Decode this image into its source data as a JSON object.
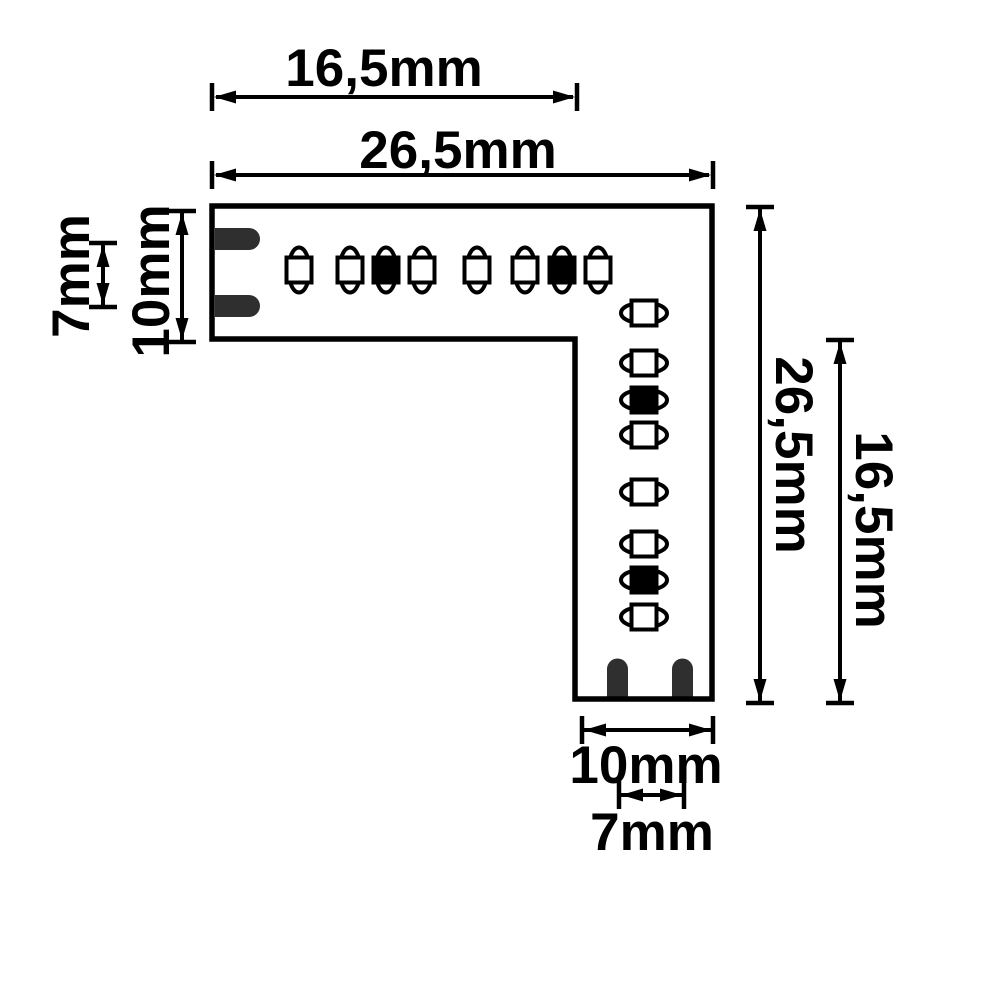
{
  "dimensions": {
    "top_inner": "16,5mm",
    "top_full": "26,5mm",
    "left_pad_pitch": "7mm",
    "left_strip_width": "10mm",
    "right_full": "26,5mm",
    "right_inner": "16,5mm",
    "bottom_strip_width": "10mm",
    "bottom_pad_pitch": "7mm"
  },
  "leds": {
    "horizontal_row_count": 8,
    "vertical_column_count": 8,
    "marked_row_positions": [
      3,
      7
    ],
    "marked_column_positions": [
      3,
      7
    ]
  },
  "pads": {
    "left_count": 2,
    "bottom_count": 2
  },
  "colors": {
    "outline": "#000000",
    "background": "#ffffff",
    "solder_pad": "#2f2f2f",
    "led_open_fill": "#ffffff",
    "led_marked_fill": "#000000"
  }
}
